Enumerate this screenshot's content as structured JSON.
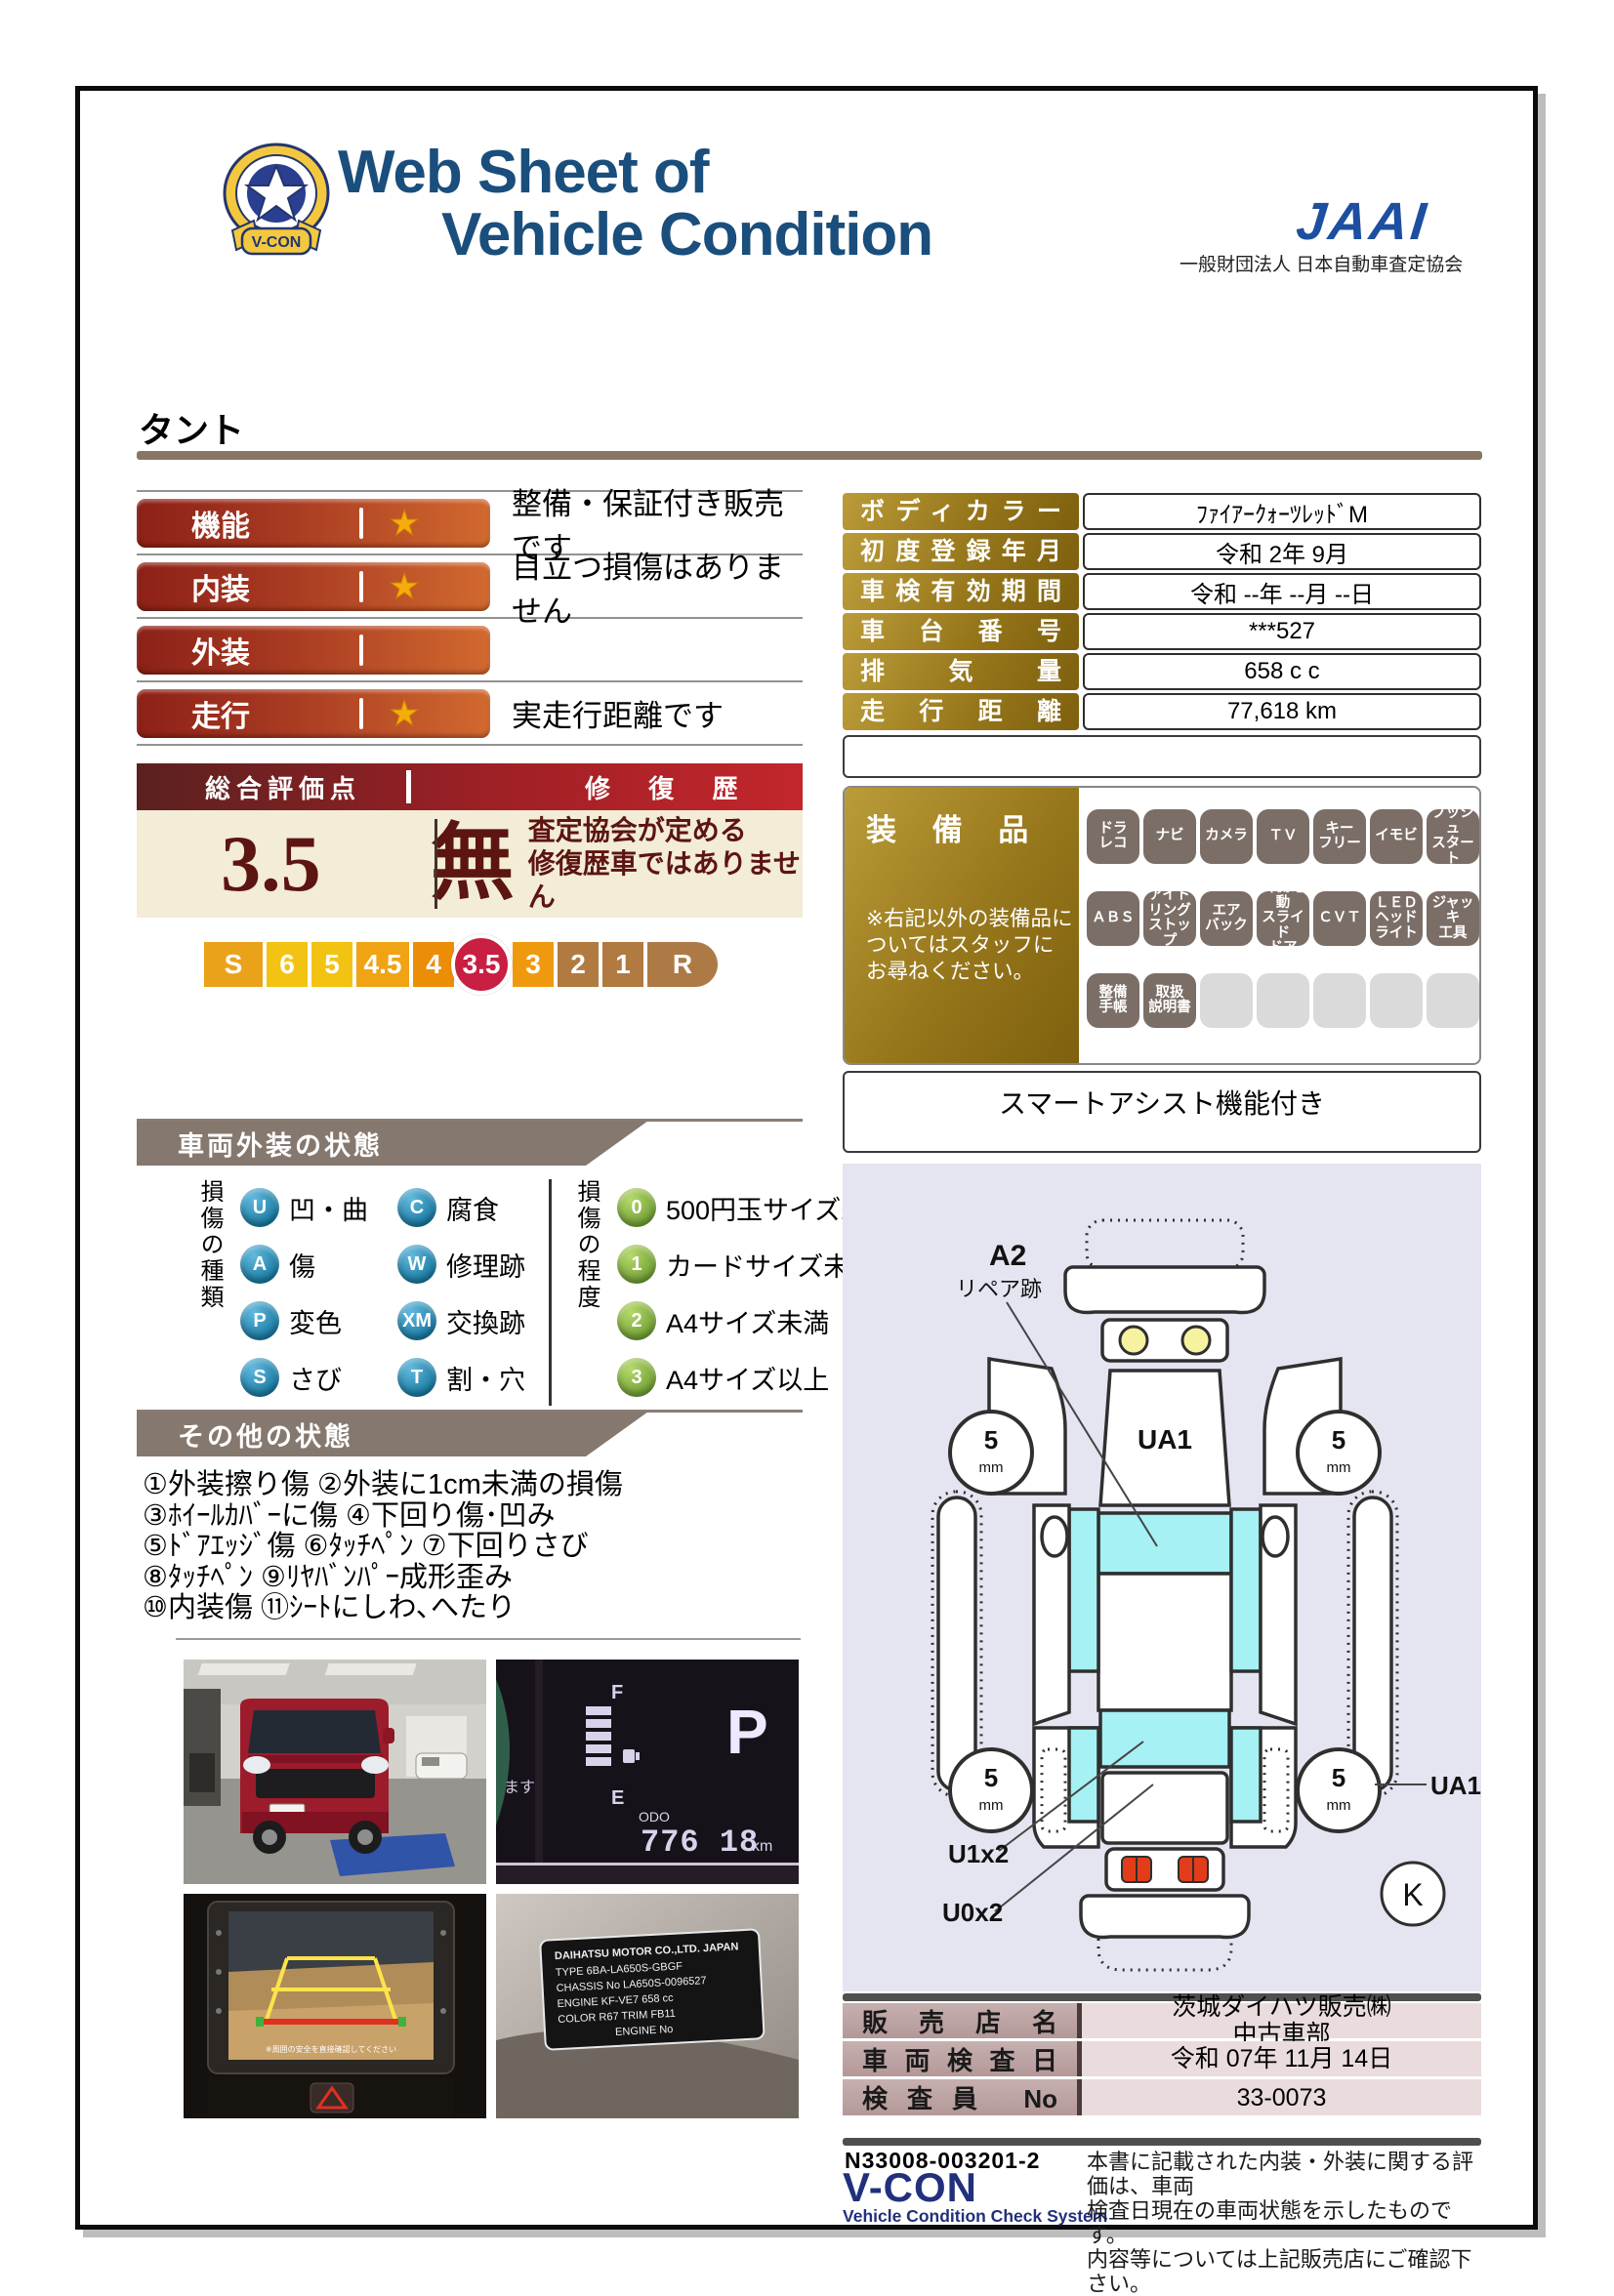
{
  "header": {
    "title_line1": "Web Sheet of",
    "title_line2": "Vehicle Condition",
    "badge_ribbon": "V-CON",
    "org_logo": "JAAI",
    "org_name": "一般財団法人 日本自動車査定協会"
  },
  "vehicle": {
    "name": "タント"
  },
  "ratings": [
    {
      "label": "機能",
      "star": true,
      "desc": "整備・保証付き販売です"
    },
    {
      "label": "内装",
      "star": true,
      "desc": "目立つ損傷はありません"
    },
    {
      "label": "外装",
      "star": false,
      "desc": ""
    },
    {
      "label": "走行",
      "star": true,
      "desc": "実走行距離です"
    }
  ],
  "overall": {
    "title": "総合評価点",
    "repair_title": "修 復 歴",
    "score": "3.5",
    "repair_value": "無",
    "note_line1": "査定協会が定める",
    "note_line2": "修復歴車ではありません"
  },
  "scale": [
    {
      "label": "S",
      "color": "#eaa21b",
      "w": 64,
      "active": false
    },
    {
      "label": "6",
      "color": "#f2c312",
      "w": 46,
      "active": false
    },
    {
      "label": "5",
      "color": "#f2c312",
      "w": 46,
      "active": false
    },
    {
      "label": "4.5",
      "color": "#f0a313",
      "w": 58,
      "active": false
    },
    {
      "label": "4",
      "color": "#ec8d07",
      "w": 46,
      "active": false
    },
    {
      "label": "3.5",
      "color": "#c81f42",
      "w": 62,
      "active": true
    },
    {
      "label": "3",
      "color": "#ef9a0e",
      "w": 46,
      "active": false
    },
    {
      "label": "2",
      "color": "#b07a41",
      "w": 46,
      "active": false
    },
    {
      "label": "1",
      "color": "#b07a41",
      "w": 46,
      "active": false
    },
    {
      "label": "R",
      "color": "#ad7a45",
      "w": 76,
      "active": false
    }
  ],
  "info_table": [
    {
      "label": "ボディカラー",
      "value": "ﾌｧｲｱｰｸｫｰﾂﾚｯﾄﾞM"
    },
    {
      "label": "初度登録年月",
      "value": "令和 2年 9月"
    },
    {
      "label": "車検有効期間",
      "value": "令和 --年 --月 --日"
    },
    {
      "label": "車台番号",
      "value": "***527"
    },
    {
      "label": "排気量",
      "value": "658 c c"
    },
    {
      "label": "走行距離",
      "value": "77,618 km"
    }
  ],
  "equipment": {
    "title": "装 備 品",
    "note": "※右記以外の装備品に\nついてはスタッフに\nお尋ねください。",
    "footer": "スマートアシスト機能付き",
    "badges": [
      {
        "label": "ドラ\nレコ",
        "on": true
      },
      {
        "label": "ナビ",
        "on": true
      },
      {
        "label": "カメラ",
        "on": true
      },
      {
        "label": "ＴＶ",
        "on": true
      },
      {
        "label": "キー\nフリー",
        "on": true
      },
      {
        "label": "イモビ",
        "on": true
      },
      {
        "label": "プッシュ\nスタート",
        "on": true
      },
      {
        "label": "ＡＢＳ",
        "on": true
      },
      {
        "label": "アイド\nリング\nストップ",
        "on": true
      },
      {
        "label": "エア\nバック",
        "on": true
      },
      {
        "label": "片側電動\nスライド\nドア",
        "on": true
      },
      {
        "label": "ＣＶＴ",
        "on": true
      },
      {
        "label": "ＬＥＤ\nヘッド\nライト",
        "on": true
      },
      {
        "label": "ジャッキ\n工具",
        "on": true
      },
      {
        "label": "整備\n手帳",
        "on": true
      },
      {
        "label": "取扱\n説明書",
        "on": true
      },
      {
        "label": "",
        "on": false
      },
      {
        "label": "",
        "on": false
      },
      {
        "label": "",
        "on": false
      },
      {
        "label": "",
        "on": false
      },
      {
        "label": "",
        "on": false
      }
    ]
  },
  "exterior": {
    "title": "車両外装の状態",
    "kind_label": "損傷の種類",
    "degree_label": "損傷の程度",
    "kinds": [
      {
        "code": "U",
        "label": "凹・曲"
      },
      {
        "code": "A",
        "label": "傷"
      },
      {
        "code": "P",
        "label": "変色"
      },
      {
        "code": "S",
        "label": "さび"
      },
      {
        "code": "C",
        "label": "腐食"
      },
      {
        "code": "W",
        "label": "修理跡"
      },
      {
        "code": "XM",
        "label": "交換跡"
      },
      {
        "code": "T",
        "label": "割・穴"
      }
    ],
    "degrees": [
      {
        "code": "0",
        "label": "500円玉サイズ未満"
      },
      {
        "code": "1",
        "label": "カードサイズ未満"
      },
      {
        "code": "2",
        "label": "A4サイズ未満"
      },
      {
        "code": "3",
        "label": "A4サイズ以上"
      }
    ]
  },
  "other": {
    "title": "その他の状態",
    "lines": [
      "①外装擦り傷 ②外装に1cm未満の損傷",
      "③ﾎｲｰﾙｶﾊﾞｰに傷 ④下回り傷･凹み",
      "⑤ﾄﾞｱｴｯｼﾞ傷 ⑥ﾀｯﾁﾍﾟﾝ ⑦下回りさび",
      "⑧ﾀｯﾁﾍﾟﾝ ⑨ﾘﾔﾊﾞﾝﾊﾟｰ成形歪み",
      "⑩内装傷 ⑪ｼｰﾄにしわ､へたり"
    ]
  },
  "diagram": {
    "repair_code": "A2",
    "repair_note": "リペア跡",
    "windshield_code": "UA1",
    "side_code": "UA1",
    "u1_code": "U1x2",
    "u0_code": "U0x2",
    "corner_code": "K",
    "wheel_value": "5",
    "wheel_unit": "mm"
  },
  "photos": {
    "odometer": {
      "f": "F",
      "e": "E",
      "odo": "ODO",
      "value": "776 18",
      "unit": "km",
      "gear": "P",
      "msg": "ます"
    },
    "plate": {
      "lines": [
        "DAIHATSU MOTOR CO.,LTD. JAPAN",
        "TYPE 6BA-LA650S-GBGF",
        "CHASSIS No LA650S-0096527",
        "ENGINE KF-VE7      658 cc",
        "COLOR R67   TRIM FB11",
        "ENGINE No"
      ]
    },
    "camera": {
      "caption": "※周囲の安全を直接確認してください"
    }
  },
  "dealer_table": [
    {
      "label": "販売店名",
      "value": "茨城ダイハツ販売㈱\n中古車部"
    },
    {
      "label": "車両検査日",
      "value": "令和 07年 11月 14日"
    },
    {
      "label": "検査員 No",
      "value": "33-0073"
    }
  ],
  "footer": {
    "doc_number": "N33008-003201-2",
    "vcon": "V-CON",
    "vcon_sub": "Vehicle Condition Check System",
    "note": "本書に記載された内装・外装に関する評価は、車両\n検査日現在の車両状態を示したものです。\n内容等については上記販売店にご確認下さい。"
  }
}
